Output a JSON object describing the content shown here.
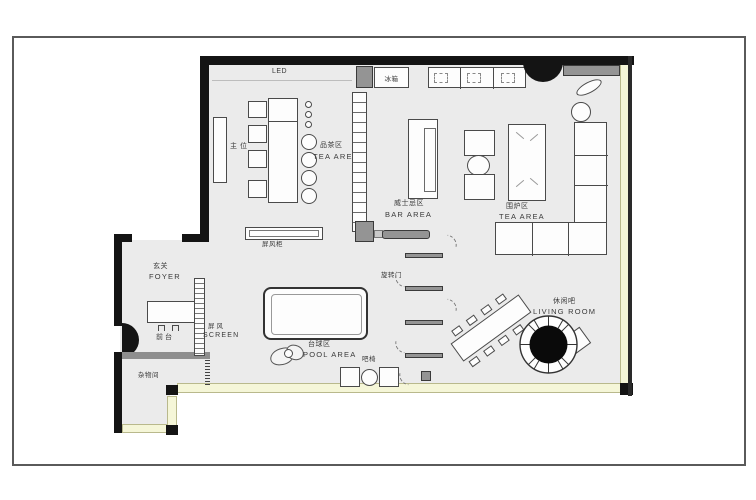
{
  "plan": {
    "areas": {
      "tea1": {
        "zh": "品茶区",
        "en": "TEA AREA"
      },
      "bar": {
        "zh": "威士忌区",
        "en": "BAR AREA"
      },
      "tea2": {
        "zh": "围炉区",
        "en": "TEA AREA"
      },
      "foyer": {
        "zh": "玄关",
        "en": "FOYER"
      },
      "pool": {
        "zh": "台球区",
        "en": "POOL AREA"
      },
      "living": {
        "zh": "休闲吧",
        "en": "LIVING ROOM"
      }
    },
    "features": {
      "led": "LED",
      "fridge": "冰箱",
      "main_seat": "主位",
      "screen_cabinet": "屏风柜",
      "revolving_door": "旋转门",
      "screen_zh": "屏风",
      "screen_en": "SCREEN",
      "reception": "前台",
      "storage": "杂物间",
      "bar_chair": "吧椅"
    },
    "colors": {
      "floor": "#ebebeb",
      "wall": "#141414",
      "lightband": "#f5f6d8",
      "counter_gray": "#949494"
    }
  }
}
